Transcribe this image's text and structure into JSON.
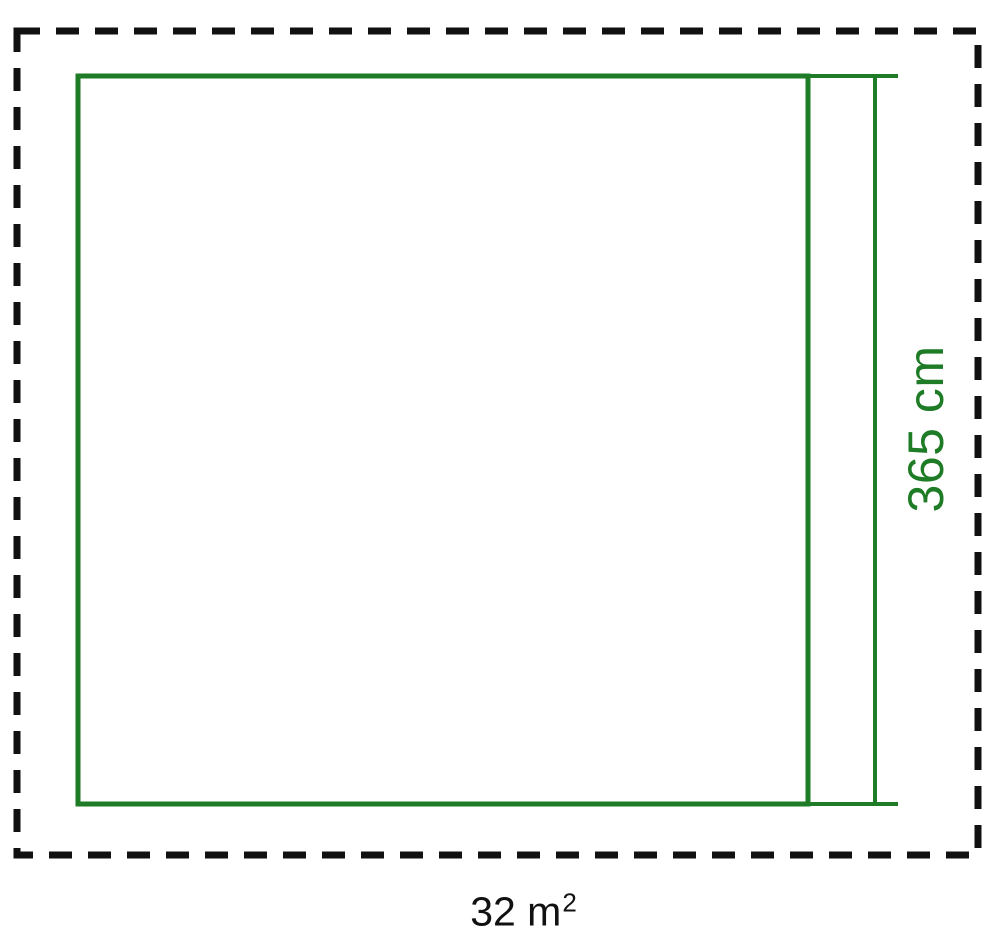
{
  "diagram": {
    "labels": {
      "height_dimension": "365 cm",
      "area_value": "32 m",
      "area_superscript": "2"
    },
    "colors": {
      "dimension_green": "#1e7b26",
      "outline_black": "#111111",
      "background": "#ffffff"
    }
  }
}
